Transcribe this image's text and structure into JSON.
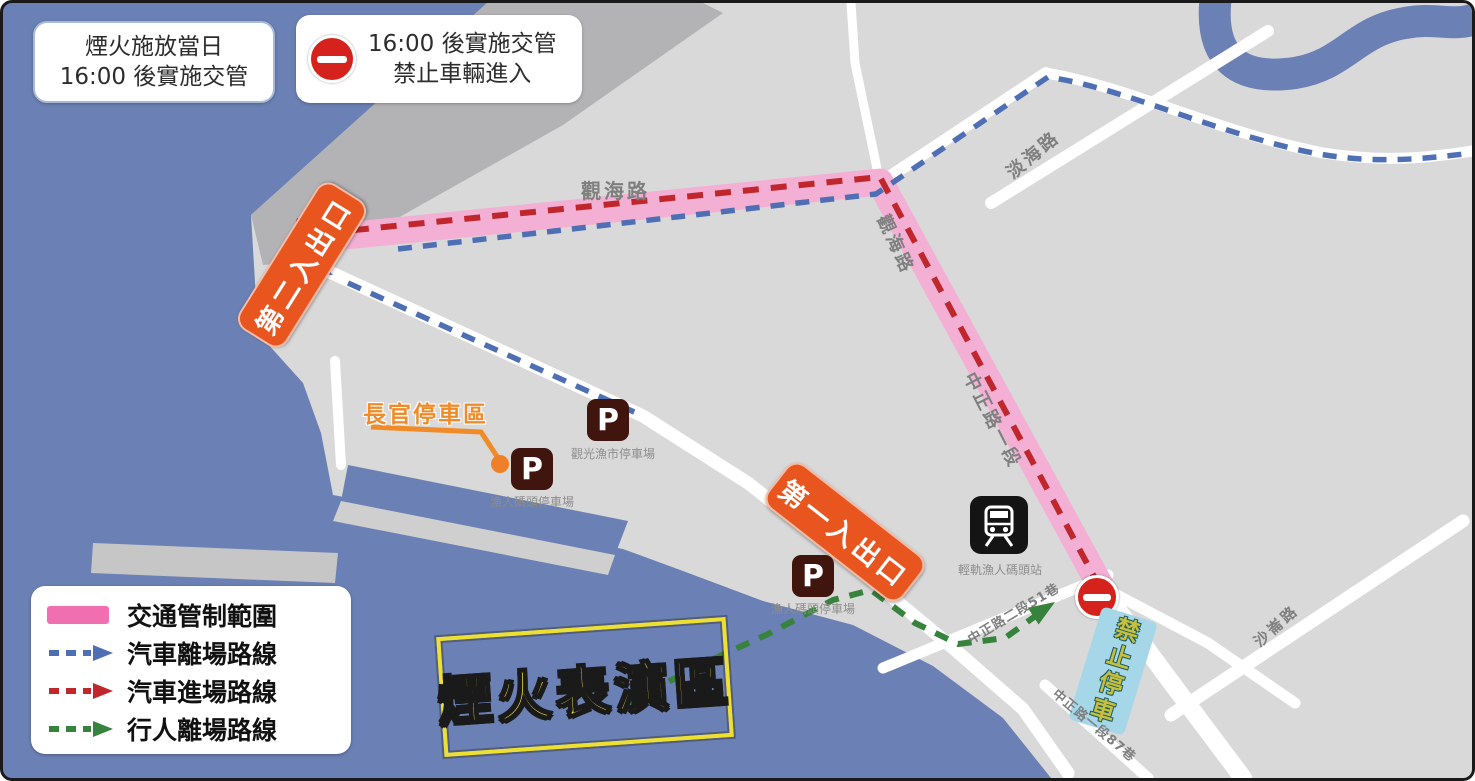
{
  "callouts": {
    "fireworks_day": {
      "line1": "煙火施放當日",
      "line2": "16:00 後實施交管"
    },
    "no_entry": {
      "line1": "16:00 後實施交管",
      "line2": "禁止車輛進入"
    }
  },
  "legend": {
    "items": [
      {
        "label": "交通管制範圍",
        "type": "zone",
        "color": "#ef6fb0"
      },
      {
        "label": "汽車離場路線",
        "type": "dashed-arrow",
        "color": "#4f6fb4"
      },
      {
        "label": "汽車進場路線",
        "type": "dashed-arrow",
        "color": "#c0272d"
      },
      {
        "label": "行人離場路線",
        "type": "dashed-arrow",
        "color": "#37823c"
      }
    ]
  },
  "map": {
    "entrances": {
      "first": "第一入出口",
      "second": "第二入出口"
    },
    "roads": {
      "guanhai_1": "觀海路",
      "guanhai_2": "觀海路",
      "danhai": "淡海路",
      "zhongzheng_sec1": "中正路一段",
      "zhongzheng_lane51": "中正路二段51巷",
      "zhongzheng_lane87": "中正路一段87巷",
      "shalun": "沙崙路"
    },
    "parking": {
      "symbol": "P",
      "tourist_fish_market": "觀光漁市停車場",
      "fisherman_wharf_1": "漁人碼頭停車場",
      "fisherman_wharf_2": "漁人碼頭停車場"
    },
    "vip_parking": "長官停車區",
    "station": "輕軌漁人碼頭站",
    "no_parking": "禁止停車",
    "fireworks_area": "煙火表演區"
  },
  "colors": {
    "sea": "#6b80b4",
    "land": "#d9d9d9",
    "breakwater": "#b3b3b6",
    "control_zone_pink": "#f3b0d4",
    "legend_pink": "#ef6fb0",
    "car_exit_blue": "#4f6fb4",
    "car_entry_red": "#c0272d",
    "pedestrian_green": "#37823c",
    "entrance_orange": "#e8551e",
    "highlight_yellow": "#f2e43a",
    "no_parking_bg": "#a5d7e8"
  }
}
